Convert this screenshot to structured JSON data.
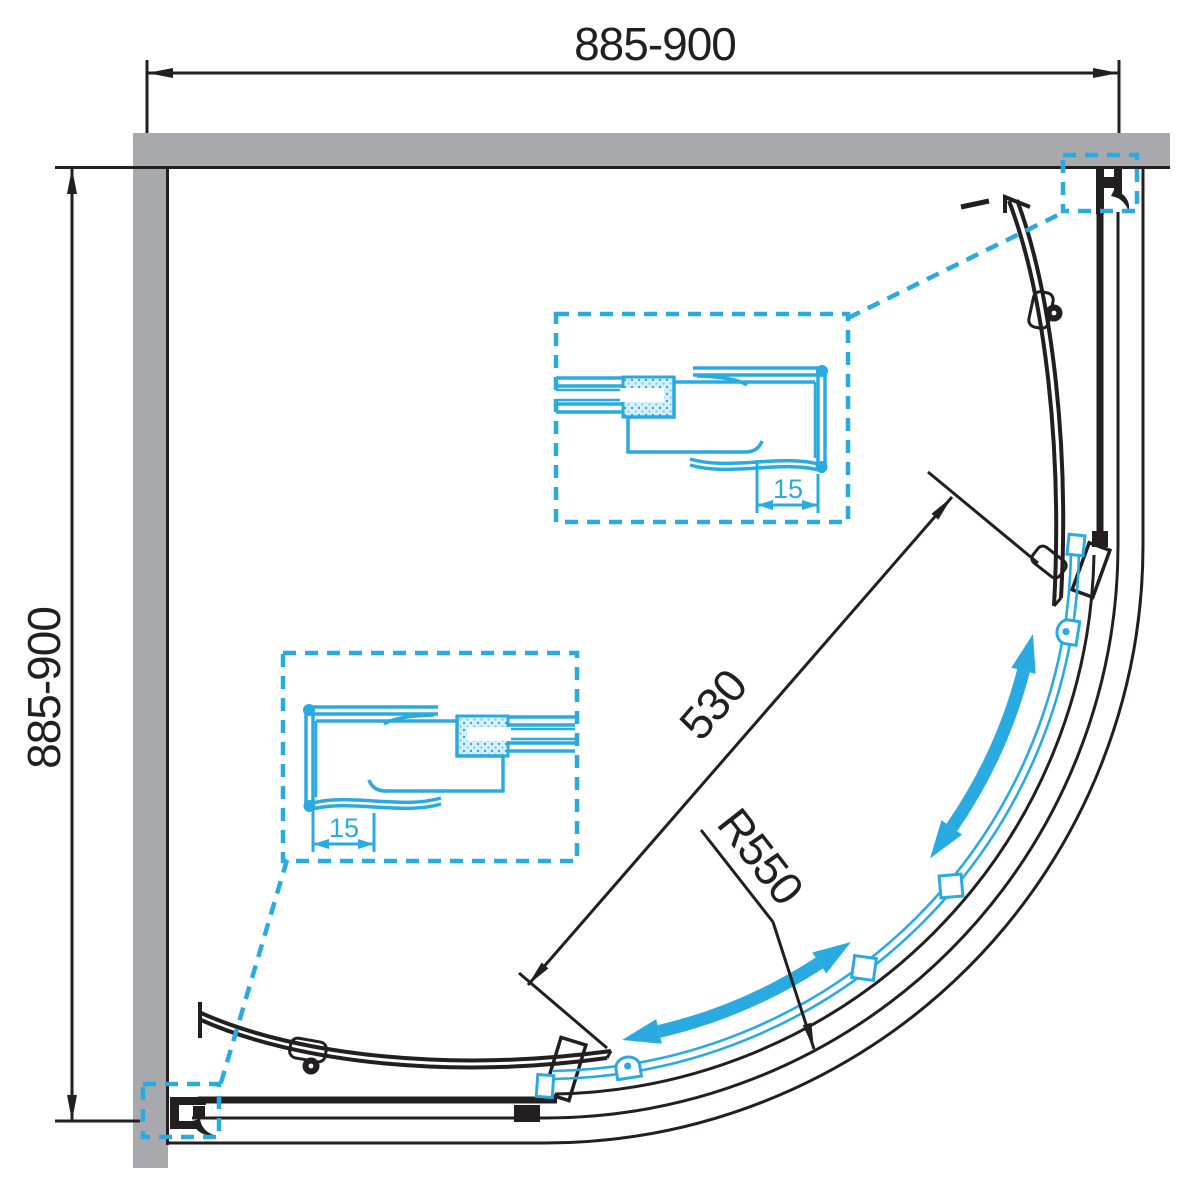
{
  "dims": {
    "top_width": "885-900",
    "side_depth": "885-900",
    "door_opening": "530",
    "radius": "R550",
    "upper_detail_gap": "15",
    "lower_detail_gap": "15"
  },
  "colors": {
    "accent": "#29ABE2",
    "wall_gray": "#A7A9AC",
    "line_black": "#231F20"
  }
}
